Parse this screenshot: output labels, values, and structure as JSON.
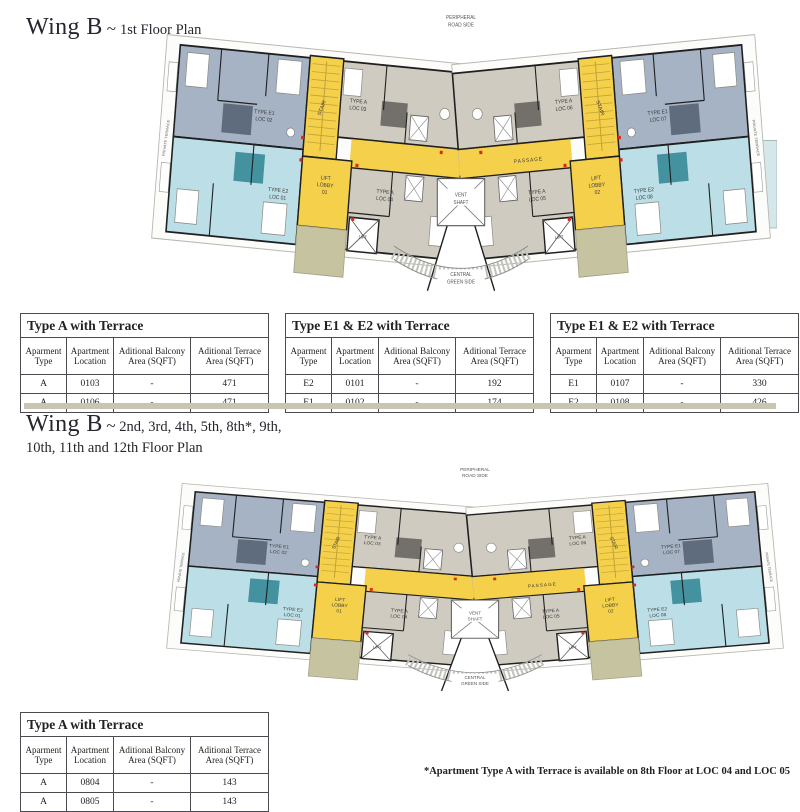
{
  "section1": {
    "title_main": "Wing B",
    "tilde": "~",
    "subtitle": "1st Floor Plan"
  },
  "section2": {
    "title_main": "Wing B",
    "tilde": "~",
    "subtitle_line1": "2nd, 3rd, 4th, 5th, 8th*, 9th,",
    "subtitle_line2": "10th, 11th and 12th Floor Plan"
  },
  "footnote": "*Apartment Type A with Terrace is available on 8th Floor at LOC 04 and LOC 05",
  "plan": {
    "labels": {
      "peripheral_road": [
        "PERIPHERAL",
        "ROAD SIDE"
      ],
      "vent_shaft": [
        "VENT",
        "SHAFT"
      ],
      "central_green": [
        "CENTRAL",
        "GREEN SIDE"
      ],
      "passage": "PASSAGE",
      "stair": "STAIR",
      "lift": "LIFT",
      "lift_lobby_left": [
        "LIFT",
        "LOBBY",
        "01"
      ],
      "lift_lobby_right": [
        "LIFT",
        "LOBBY",
        "02"
      ],
      "private_terrace": "PRIVATE TERRACE",
      "units": {
        "e2_left": [
          "TYPE E2",
          "LOC 01"
        ],
        "e1_left": [
          "TYPE E1",
          "LOC 02"
        ],
        "a_left_top": [
          "TYPE A",
          "LOC 03"
        ],
        "a_left_bottom": [
          "TYPE A",
          "LOC 04"
        ],
        "a_right_bottom": [
          "TYPE A",
          "LOC 05"
        ],
        "a_right_top": [
          "TYPE A",
          "LOC 06"
        ],
        "e1_right": [
          "TYPE E1",
          "LOC 07"
        ],
        "e2_right": [
          "TYPE E2",
          "LOC 08"
        ]
      }
    }
  },
  "tables": {
    "headers": [
      "Aparment\nType",
      "Apartment\nLocation",
      "Aditional Balcony\nArea (SQFT)",
      "Aditional Terrace\nArea (SQFT)"
    ],
    "list": [
      {
        "title": "Type A with Terrace",
        "rows": [
          [
            "A",
            "0103",
            "-",
            "471"
          ],
          [
            "A",
            "0106",
            "-",
            "471"
          ]
        ]
      },
      {
        "title": "Type E1 & E2 with Terrace",
        "rows": [
          [
            "E2",
            "0101",
            "-",
            "192"
          ],
          [
            "E1",
            "0102",
            "-",
            "174"
          ]
        ]
      },
      {
        "title": "Type E1 & E2 with Terrace",
        "rows": [
          [
            "E1",
            "0107",
            "-",
            "330"
          ],
          [
            "E2",
            "0108",
            "-",
            "426"
          ]
        ]
      },
      {
        "title": "Type A with Terrace",
        "rows": [
          [
            "A",
            "0804",
            "-",
            "143"
          ],
          [
            "A",
            "0805",
            "-",
            "143"
          ]
        ]
      }
    ]
  },
  "colors": {
    "accent_yellow": "#f5d04b",
    "unit_e1": "#a6b3c4",
    "unit_e1_dark": "#5e6c7e",
    "unit_e2": "#bcdfe7",
    "unit_e2_dark": "#44929f",
    "unit_a": "#cfcbc1",
    "unit_a_dark": "#736f6a",
    "terrace_olive": "#c6c3a0",
    "end_terrace": "#d6e7ea",
    "marker_red": "#d6281e",
    "wall": "#1f1f1f",
    "divider_tan": "#c8c5b3"
  }
}
